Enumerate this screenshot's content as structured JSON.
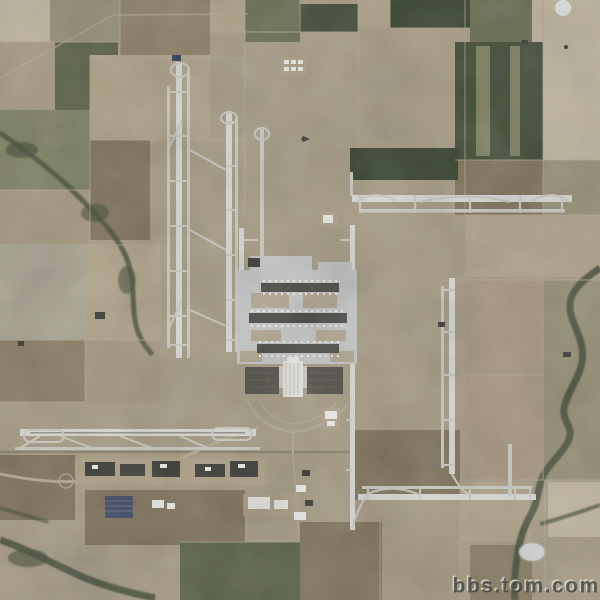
{
  "image": {
    "kind": "satellite-aerial-photograph",
    "subject": "large hub airport (Denver International Airport style) surrounded by farmland patchwork",
    "visible_features": [
      "two parallel north-south runways on the west side",
      "second north-south runway pair toward center",
      "long east-west runway upper right",
      "north-south runway on the east side",
      "east-west runway with looped taxiways lower left",
      "east-west runway lower right",
      "central terminal with three dark concourses and white tent-roof terminal",
      "cargo building row south of the southwest runway",
      "blue solar/panel array near bottom left of cargo area",
      "fuel tank farm at top center",
      "meandering creek on right side and northwest",
      "farm field patchwork in tan, brown, olive and dark green",
      "diagonal access road at top left",
      "highway interchange at bottom left"
    ]
  },
  "watermark": {
    "text": "bbs.tom.com"
  },
  "palette": {
    "base": "#aaa089",
    "field_pale": "#c2b8a2",
    "field_tan": "#b2a68c",
    "field_tan2": "#a89c84",
    "field_gray_tan": "#aea896",
    "field_olive_tan": "#9a947a",
    "field_olive": "#838566",
    "field_olive2": "#6e7256",
    "field_dark_olive": "#5f664c",
    "field_green_dark": "#47523c",
    "field_green_deep": "#3e4936",
    "field_brown": "#8f8369",
    "field_brown2": "#847860",
    "field_pink": "#b5a68f",
    "field_pink2": "#ab9a85",
    "runway": "#dcdcd8",
    "taxiway": "#cdcdc6",
    "apron": "#c7cac9",
    "concourse": "#514f4b",
    "island": "#b2a58c",
    "terminal_white": "#ebe9e4",
    "parking": "#5a5750",
    "building_dark": "#42423e",
    "building_white": "#efefec",
    "road": "#b6ad97",
    "road_dark": "#8f8773",
    "creek": "#49523c",
    "water": "#dfe4e4",
    "blue_roof": "#31405c",
    "solar": "#47506b",
    "watermark_dark": "#45453f",
    "watermark_light": "#d8d5cb"
  }
}
